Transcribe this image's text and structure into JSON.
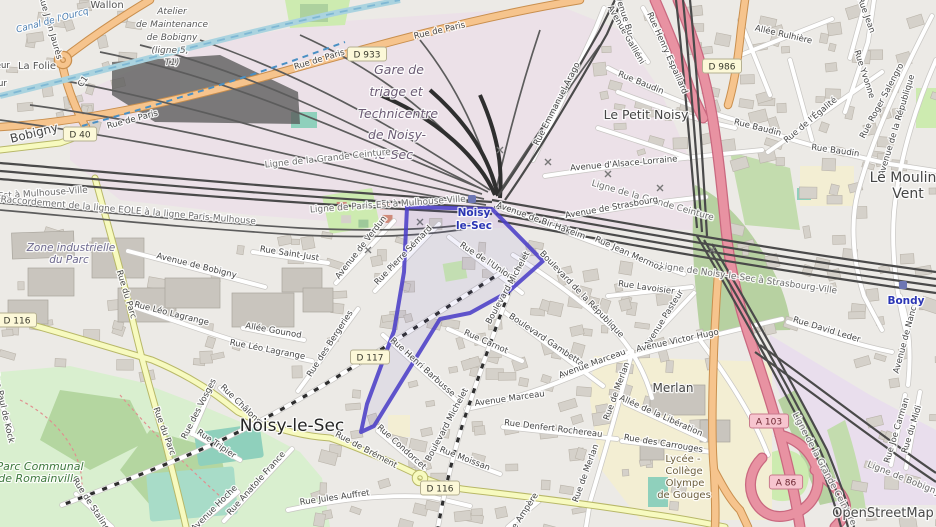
{
  "map": {
    "attribution": {
      "text": "OpenStreetMap"
    },
    "colors": {
      "selection": "#4b3fc7",
      "motorway": "#e892a2",
      "trunk_orange": "#f6c48d",
      "secondary_yellow": "#f7fabf",
      "water": "#aad3df",
      "park": "#cdebb0",
      "station_blue": "#2b35b5"
    },
    "stations": [
      {
        "lines": [
          "Noisy",
          "le-Sec"
        ],
        "icon_x": 472,
        "icon_y": 199,
        "label_x": 474,
        "label_y": 216
      },
      {
        "lines": [
          "Bondy"
        ],
        "icon_x": 903,
        "icon_y": 285,
        "label_x": 906,
        "label_y": 304
      }
    ],
    "badges": [
      {
        "ref": "D 40",
        "x": 80,
        "y": 134,
        "k": "d"
      },
      {
        "ref": "D 933",
        "x": 367,
        "y": 54,
        "k": "d"
      },
      {
        "ref": "D 986",
        "x": 722,
        "y": 66,
        "k": "d"
      },
      {
        "ref": "D 116",
        "x": 17,
        "y": 320,
        "k": "d"
      },
      {
        "ref": "D 117",
        "x": 370,
        "y": 357,
        "k": "d"
      },
      {
        "ref": "D 116",
        "x": 440,
        "y": 488,
        "k": "d"
      },
      {
        "ref": "A 103",
        "x": 769,
        "y": 421,
        "k": "a"
      },
      {
        "ref": "A 86",
        "x": 786,
        "y": 482,
        "k": "a"
      }
    ],
    "labels": [
      {
        "t": "Rue de Paris",
        "x": 133,
        "y": 122,
        "r": -15,
        "c": "st"
      },
      {
        "t": "Rue de Paris",
        "x": 320,
        "y": 62,
        "r": -17,
        "c": "st"
      },
      {
        "t": "Rue de Paris",
        "x": 440,
        "y": 33,
        "r": -13,
        "c": "st"
      },
      {
        "t": "Rue Jean Jaurès",
        "x": 48,
        "y": 28,
        "r": 74,
        "c": "st"
      },
      {
        "t": "Canal de l'Ourcq",
        "x": 53,
        "y": 23,
        "r": -15,
        "c": "water"
      },
      {
        "t": "Wallon",
        "x": 107,
        "y": 8,
        "r": 0,
        "c": "place"
      },
      {
        "t": "Atelier",
        "x": 172,
        "y": 14,
        "r": 0,
        "c": "poi"
      },
      {
        "t": "de Maintenance",
        "x": 172,
        "y": 27,
        "r": 0,
        "c": "poi"
      },
      {
        "t": "de Bobigny",
        "x": 172,
        "y": 40,
        "r": 0,
        "c": "poi"
      },
      {
        "t": "(ligne 5,",
        "x": 170,
        "y": 53,
        "r": 0,
        "c": "poi"
      },
      {
        "t": "T1)",
        "x": 172,
        "y": 65,
        "r": 0,
        "c": "poi"
      },
      {
        "t": "La Folie",
        "x": 37,
        "y": 69,
        "r": 0,
        "c": "place"
      },
      {
        "t": "Pasteur",
        "x": -6,
        "y": 68,
        "r": 0,
        "c": "st"
      },
      {
        "t": "Pasteur",
        "x": -9,
        "y": 86,
        "r": 0,
        "c": "st"
      },
      {
        "t": "C1",
        "x": 85,
        "y": 83,
        "r": -55,
        "c": "st"
      },
      {
        "t": "Bobigny",
        "x": 35,
        "y": 137,
        "r": -14,
        "c": "sub"
      },
      {
        "t": "Gare de",
        "x": 399,
        "y": 74,
        "r": 0,
        "c": "ind"
      },
      {
        "t": "triage et",
        "x": 396,
        "y": 96,
        "r": 0,
        "c": "ind"
      },
      {
        "t": "Technicentre",
        "x": 398,
        "y": 118,
        "r": 0,
        "c": "ind"
      },
      {
        "t": "de Noisy-",
        "x": 397,
        "y": 139,
        "r": 0,
        "c": "ind"
      },
      {
        "t": "le-Sec",
        "x": 394,
        "y": 159,
        "r": 0,
        "c": "ind"
      },
      {
        "t": "Ligne de la Grande Ceinture",
        "x": 328,
        "y": 161,
        "r": -6,
        "c": "rail"
      },
      {
        "t": "Ligne de Paris-Est à Mulhouse-Ville",
        "x": 388,
        "y": 207,
        "r": -4,
        "c": "rail"
      },
      {
        "t": "Ligne de Paris-Est à Mulhouse-Ville",
        "x": 10,
        "y": 198,
        "r": -4,
        "c": "rail"
      },
      {
        "t": "Raccordement de la ligne EOLE à la ligne Paris-Mulhouse",
        "x": 128,
        "y": 213,
        "r": 5,
        "c": "rail"
      },
      {
        "t": "Ligne de la Grande Ceinture",
        "x": 652,
        "y": 203,
        "r": 16,
        "c": "rail"
      },
      {
        "t": "Ligne de Noisy-le-Sec à Strasbourg-Ville",
        "x": 748,
        "y": 281,
        "r": 8,
        "c": "rail"
      },
      {
        "t": "Ligne de la Grande Ceinture",
        "x": 822,
        "y": 470,
        "r": 62,
        "c": "rail"
      },
      {
        "t": "Ligne de Bobigny",
        "x": 903,
        "y": 481,
        "r": 22,
        "c": "rail"
      },
      {
        "t": "Avenue d'Alsace-Lorraine",
        "x": 624,
        "y": 166,
        "r": -5,
        "c": "st"
      },
      {
        "t": "Avenue de Strasbourg",
        "x": 612,
        "y": 210,
        "r": -10,
        "c": "st"
      },
      {
        "t": "Avenue de Bir-Hakeim",
        "x": 540,
        "y": 223,
        "r": 20,
        "c": "st"
      },
      {
        "t": "Rue Emmanuel Arago",
        "x": 559,
        "y": 105,
        "r": -63,
        "c": "st"
      },
      {
        "t": "Le Petit Noisy",
        "x": 646,
        "y": 119,
        "r": 0,
        "c": "sub",
        "s": 12.5
      },
      {
        "t": "Allée Rulhière",
        "x": 783,
        "y": 37,
        "r": 13,
        "c": "st"
      },
      {
        "t": "Rue Henry Espaillard",
        "x": 665,
        "y": 54,
        "r": 66,
        "c": "st"
      },
      {
        "t": "Avenue Galliéni",
        "x": 624,
        "y": 36,
        "r": 60,
        "c": "st"
      },
      {
        "t": "Avenue Bu",
        "x": 621,
        "y": 14,
        "r": 72,
        "c": "st"
      },
      {
        "t": "Rue Baudin",
        "x": 640,
        "y": 85,
        "r": 22,
        "c": "st"
      },
      {
        "t": "Rue Baudin",
        "x": 757,
        "y": 130,
        "r": 14,
        "c": "st"
      },
      {
        "t": "Rue Baudin",
        "x": 835,
        "y": 153,
        "r": 8,
        "c": "st"
      },
      {
        "t": "Rue de l'Égalité",
        "x": 812,
        "y": 122,
        "r": -40,
        "c": "st"
      },
      {
        "t": "Rue Yvonne",
        "x": 862,
        "y": 75,
        "r": 72,
        "c": "st"
      },
      {
        "t": "Rue Jean",
        "x": 864,
        "y": 16,
        "r": 70,
        "c": "st"
      },
      {
        "t": "Rue Roger Salengro",
        "x": 884,
        "y": 102,
        "r": -62,
        "c": "st"
      },
      {
        "t": "Avenue de la République",
        "x": 899,
        "y": 126,
        "r": -73,
        "c": "st"
      },
      {
        "t": "Le Moulin",
        "x": 903,
        "y": 182,
        "r": 0,
        "c": "sub",
        "s": 14
      },
      {
        "t": "Vent",
        "x": 908,
        "y": 198,
        "r": 0,
        "c": "sub",
        "s": 14
      },
      {
        "t": "Avenue de Nancy",
        "x": 908,
        "y": 338,
        "r": -75,
        "c": "st"
      },
      {
        "t": "Rue Jean Mermoz",
        "x": 628,
        "y": 256,
        "r": 24,
        "c": "st"
      },
      {
        "t": "Rue Lavoisier",
        "x": 646,
        "y": 290,
        "r": 8,
        "c": "st"
      },
      {
        "t": "Boulevard de la République",
        "x": 580,
        "y": 296,
        "r": 46,
        "c": "st"
      },
      {
        "t": "Avenue Pasteur",
        "x": 666,
        "y": 320,
        "r": -58,
        "c": "st"
      },
      {
        "t": "Rue de l'Union",
        "x": 485,
        "y": 263,
        "r": 33,
        "c": "st"
      },
      {
        "t": "Rue Pierre Sémard",
        "x": 405,
        "y": 257,
        "r": -46,
        "c": "st"
      },
      {
        "t": "Avenue de Verdun",
        "x": 363,
        "y": 249,
        "r": -52,
        "c": "st"
      },
      {
        "t": "Rue Saint-Just",
        "x": 289,
        "y": 256,
        "r": 9,
        "c": "st"
      },
      {
        "t": "Avenue de Bobigny",
        "x": 196,
        "y": 268,
        "r": 14,
        "c": "st"
      },
      {
        "t": "Rue du Parc",
        "x": 124,
        "y": 295,
        "r": 73,
        "c": "st"
      },
      {
        "t": "Rue du Parc",
        "x": 162,
        "y": 432,
        "r": 70,
        "c": "st"
      },
      {
        "t": "Rue Léo Lagrange",
        "x": 171,
        "y": 316,
        "r": 14,
        "c": "st"
      },
      {
        "t": "Rue Léo Lagrange",
        "x": 267,
        "y": 352,
        "r": 11,
        "c": "st"
      },
      {
        "t": "Allée Gounod",
        "x": 273,
        "y": 333,
        "r": 10,
        "c": "st"
      },
      {
        "t": "Rue des Bergeries",
        "x": 332,
        "y": 345,
        "r": -57,
        "c": "st"
      },
      {
        "t": "Rue Henri Barbusse",
        "x": 421,
        "y": 369,
        "r": 42,
        "c": "st"
      },
      {
        "t": "Zone industrielle",
        "x": 71,
        "y": 251,
        "r": 0,
        "c": "ind2"
      },
      {
        "t": "du Parc",
        "x": 69,
        "y": 263,
        "r": 0,
        "c": "ind2"
      },
      {
        "t": "Rue des Vosges",
        "x": 201,
        "y": 410,
        "r": -63,
        "c": "st"
      },
      {
        "t": "Rue Châlons",
        "x": 239,
        "y": 406,
        "r": 44,
        "c": "st"
      },
      {
        "t": "Rue Tripier",
        "x": 215,
        "y": 446,
        "r": 34,
        "c": "st"
      },
      {
        "t": "Rue Paul de Kock",
        "x": 1,
        "y": 408,
        "r": 77,
        "c": "st"
      },
      {
        "t": "Parc Communal",
        "x": 40,
        "y": 470,
        "r": 0,
        "c": "park"
      },
      {
        "t": "de Romainville",
        "x": 39,
        "y": 482,
        "r": 0,
        "c": "park"
      },
      {
        "t": "Avenue Hoche",
        "x": 216,
        "y": 510,
        "r": -45,
        "c": "st"
      },
      {
        "t": "Rue Anatole France",
        "x": 258,
        "y": 485,
        "r": -48,
        "c": "st"
      },
      {
        "t": "Rue de Stalingrad",
        "x": 93,
        "y": 512,
        "r": 57,
        "c": "st"
      },
      {
        "t": "Noisy-le-Sec",
        "x": 292,
        "y": 431,
        "r": 0,
        "c": "town",
        "s": 17
      },
      {
        "t": "Rue de Brément",
        "x": 365,
        "y": 452,
        "r": 28,
        "c": "st"
      },
      {
        "t": "Rue Jules Auffret",
        "x": 335,
        "y": 500,
        "r": -8,
        "c": "st"
      },
      {
        "t": "Rue Condorcet",
        "x": 400,
        "y": 449,
        "r": 42,
        "c": "st"
      },
      {
        "t": "Rue Moissan",
        "x": 464,
        "y": 461,
        "r": 21,
        "c": "st"
      },
      {
        "t": "Boulevard Michelet",
        "x": 510,
        "y": 289,
        "r": -61,
        "c": "st"
      },
      {
        "t": "Boulevard Michelet",
        "x": 449,
        "y": 426,
        "r": -62,
        "c": "st"
      },
      {
        "t": "Rue Carnot",
        "x": 485,
        "y": 344,
        "r": 24,
        "c": "st"
      },
      {
        "t": "Boulevard Gambetta",
        "x": 545,
        "y": 342,
        "r": 34,
        "c": "st"
      },
      {
        "t": "Avenue Marceau",
        "x": 593,
        "y": 366,
        "r": -20,
        "c": "st"
      },
      {
        "t": "Avenue Marceau",
        "x": 510,
        "y": 401,
        "r": -8,
        "c": "st"
      },
      {
        "t": "Avenue Victor Hugo",
        "x": 678,
        "y": 343,
        "r": -12,
        "c": "st"
      },
      {
        "t": "Rue de Merlan",
        "x": 619,
        "y": 392,
        "r": -70,
        "c": "st"
      },
      {
        "t": "Rue de Merlan",
        "x": 588,
        "y": 474,
        "r": -70,
        "c": "st"
      },
      {
        "t": "Allée de la Libération",
        "x": 660,
        "y": 418,
        "r": 24,
        "c": "st"
      },
      {
        "t": "Rue Denfert Rochereau",
        "x": 553,
        "y": 431,
        "r": 7,
        "c": "st"
      },
      {
        "t": "Rue des Carrouges",
        "x": 663,
        "y": 446,
        "r": 9,
        "c": "st"
      },
      {
        "t": "Merlan",
        "x": 673,
        "y": 392,
        "r": 0,
        "c": "sub"
      },
      {
        "t": "Lycée -",
        "x": 683,
        "y": 462,
        "r": 0,
        "c": "sch"
      },
      {
        "t": "Collège",
        "x": 684,
        "y": 474,
        "r": 0,
        "c": "sch"
      },
      {
        "t": "Olympe",
        "x": 685,
        "y": 486,
        "r": 0,
        "c": "sch"
      },
      {
        "t": "de Gouges",
        "x": 684,
        "y": 498,
        "r": 0,
        "c": "sch"
      },
      {
        "t": "Rue Ampère",
        "x": 524,
        "y": 517,
        "r": -57,
        "c": "st"
      },
      {
        "t": "Rue David Leder",
        "x": 826,
        "y": 332,
        "r": 17,
        "c": "st"
      },
      {
        "t": "Rue du Midi",
        "x": 914,
        "y": 430,
        "r": -73,
        "c": "st"
      },
      {
        "t": "Rue Joe Carman",
        "x": 899,
        "y": 431,
        "r": -73,
        "c": "st"
      }
    ]
  }
}
